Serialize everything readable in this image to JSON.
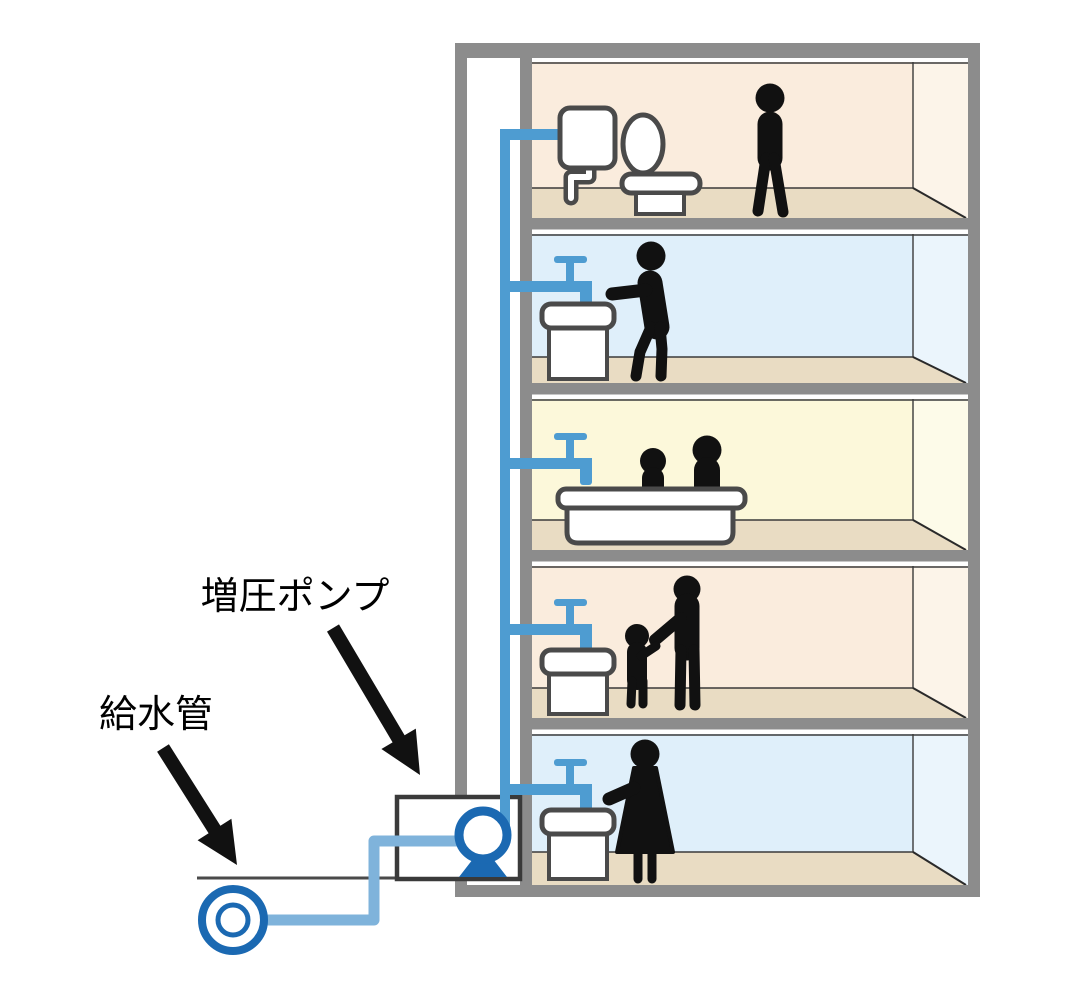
{
  "labels": {
    "booster_pump": "増圧ポンプ",
    "supply_pipe": "給水管"
  },
  "colors": {
    "structure_gray": "#8C8C8C",
    "pipe_blue": "#4E9CD1",
    "supply_pipe_blue": "#7FB3DB",
    "pump_blue": "#1B69B2",
    "room_peach": "#FAECDD",
    "room_peach_side": "#FCF4E9",
    "room_blue": "#DFEFFA",
    "room_blue_side": "#EBF5FC",
    "room_yellow": "#FCF8DA",
    "room_yellow_side": "#FDFBE9",
    "floor_beige": "#E9DCC3",
    "fixture_outline": "#4A4A4A",
    "silhouette_black": "#111111"
  },
  "floors": [
    {
      "position": "top",
      "room_tint": "peach",
      "fixture": "toilet-icon",
      "occupants": [
        "standing-person-icon"
      ]
    },
    {
      "position": "second",
      "room_tint": "blue",
      "fixture": "washbasin-icon",
      "occupants": [
        "person-washing-hands-icon"
      ]
    },
    {
      "position": "third",
      "room_tint": "yellow",
      "fixture": "bathtub-icon",
      "occupants": [
        "adult-bathing-icon",
        "child-bathing-icon"
      ]
    },
    {
      "position": "fourth",
      "room_tint": "peach",
      "fixture": "washbasin-icon",
      "occupants": [
        "adult-icon",
        "child-icon"
      ]
    },
    {
      "position": "ground",
      "room_tint": "blue",
      "fixture": "washbasin-icon",
      "occupants": [
        "woman-washing-hands-icon"
      ]
    }
  ],
  "equipment": {
    "booster_pump": "pump-icon",
    "water_main": "water-main-icon",
    "riser": "riser-pipe"
  }
}
